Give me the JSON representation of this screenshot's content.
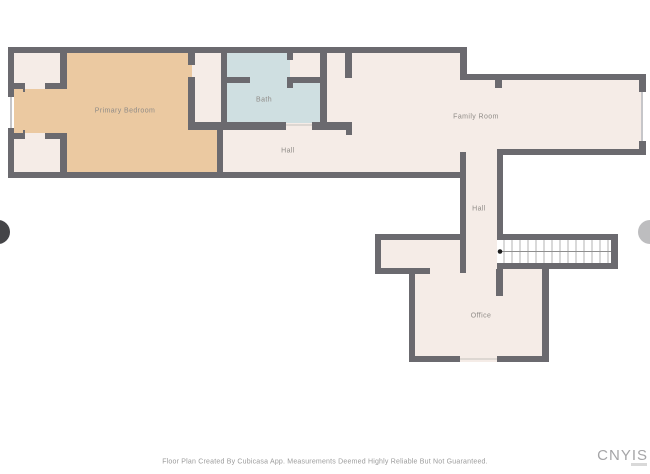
{
  "rooms": {
    "primary_bedroom": "Primary Bedroom",
    "bath": "Bath",
    "hall_upper": "Hall",
    "family_room": "Family Room",
    "hall_lower": "Hall",
    "office": "Office"
  },
  "footer": {
    "disclaimer": "Floor Plan Created By Cubicasa App. Measurements Deemed Highly Reliable But Not Guaranteed."
  },
  "watermark": {
    "text": "CNYIS"
  },
  "colors": {
    "wall": "#6b6a6f",
    "floor": "#f5ece7",
    "bedroom": "#ebc9a1",
    "bath": "#cfdfe1",
    "background": "#ffffff"
  }
}
